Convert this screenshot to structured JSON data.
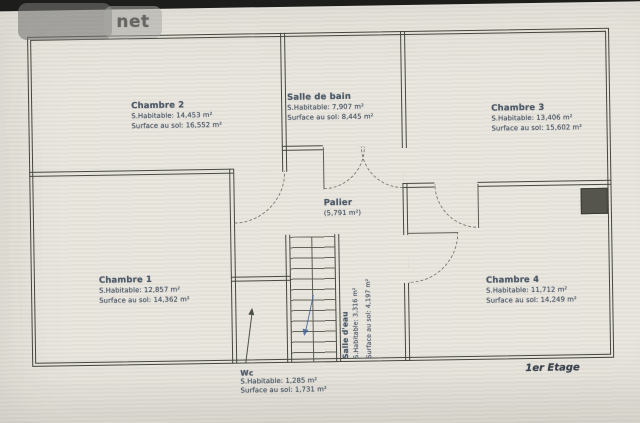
{
  "watermark": {
    "text": "net"
  },
  "plan": {
    "floor_label": "1er Etage",
    "rooms": {
      "chambre2": {
        "name": "Chambre 2",
        "habitable": "S.Habitable: 14,453 m²",
        "surface_sol": "Surface au sol: 16,552 m²"
      },
      "salle_de_bain": {
        "name": "Salle de bain",
        "habitable": "S.Habitable: 7,907 m²",
        "surface_sol": "Surface au sol: 8,445 m²"
      },
      "chambre3": {
        "name": "Chambre 3",
        "habitable": "S.Habitable: 13,406 m²",
        "surface_sol": "Surface au sol: 15,602 m²"
      },
      "palier": {
        "name": "Palier",
        "area": "(5,791 m²)"
      },
      "chambre1": {
        "name": "Chambre 1",
        "habitable": "S.Habitable: 12,857 m²",
        "surface_sol": "Surface au sol: 14,362 m²"
      },
      "chambre4": {
        "name": "Chambre 4",
        "habitable": "S.Habitable: 11,712 m²",
        "surface_sol": "Surface au sol: 14,249 m²"
      },
      "salle_deau": {
        "name": "Salle d'eau",
        "habitable": "S.Habitable: 3,316 m²",
        "surface_sol": "Surface au sol: 4,197 m²"
      },
      "wc": {
        "name": "Wc",
        "habitable": "S.Habitable: 1,285 m²",
        "surface_sol": "Surface au sol: 1,731 m²"
      }
    }
  },
  "colors": {
    "paper": "#e9e6df",
    "wall": "#46483f",
    "label_text": "#4e5a68",
    "background": "#1d1d1b",
    "stairs_arrow": "#44639a"
  }
}
